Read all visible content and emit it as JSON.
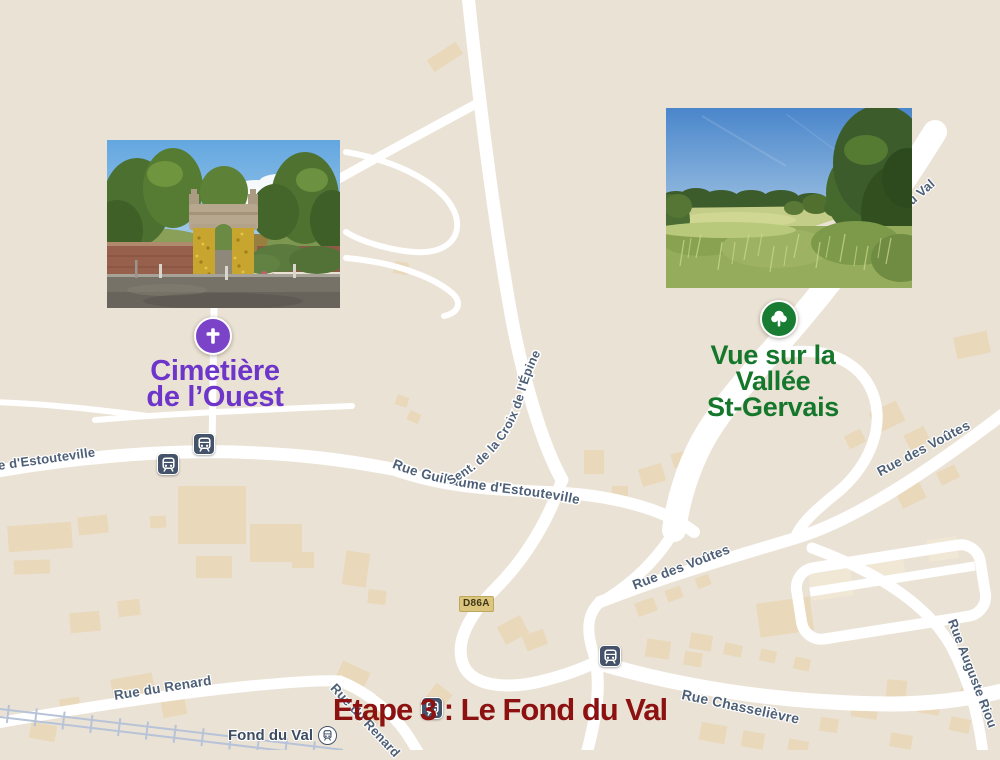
{
  "colors": {
    "map_bg": "#eae2d4",
    "road": "#ffffff",
    "building": "#e9d8ba",
    "building_light": "#f0e7d5",
    "street_label": "#4e6077",
    "railway": "#b7c3d8",
    "purple_marker": "#7b44c8",
    "purple_text": "#6d35c9",
    "green_marker": "#187c33",
    "green_text": "#15772b",
    "title_red": "#8c1212",
    "transit_navy": "#44536a",
    "badge_bg": "#dcc57d",
    "badge_text": "#3f361a"
  },
  "streets": {
    "estouteville_left": "e d'Estouteville",
    "guillaume": "Rue Guillaume d'Estouteville",
    "sentier": "Sent. de la Croix de l'Épine",
    "voutes": "Rue des Voûtes",
    "auguste": "Rue Auguste Riou",
    "du_val": "du Val",
    "renard": "Rue du Renard",
    "chasselievre": "Rue Chasselièvre",
    "fond_du_val": "Fond du Val",
    "road_badge": "D86A"
  },
  "pois": {
    "cemetery": {
      "line1": "Cimetière",
      "line2": "de l’Ouest"
    },
    "valley": {
      "line1": "Vue sur la",
      "line2": "Vallée",
      "line3": "St-Gervais"
    }
  },
  "photos": {
    "cemetery_alt": "Cemetery entrance gate decorated with yellow flowers",
    "valley_alt": "Meadow view over the St-Gervais valley"
  },
  "title": {
    "text": "Etape 3 : Le Fond du Val"
  }
}
